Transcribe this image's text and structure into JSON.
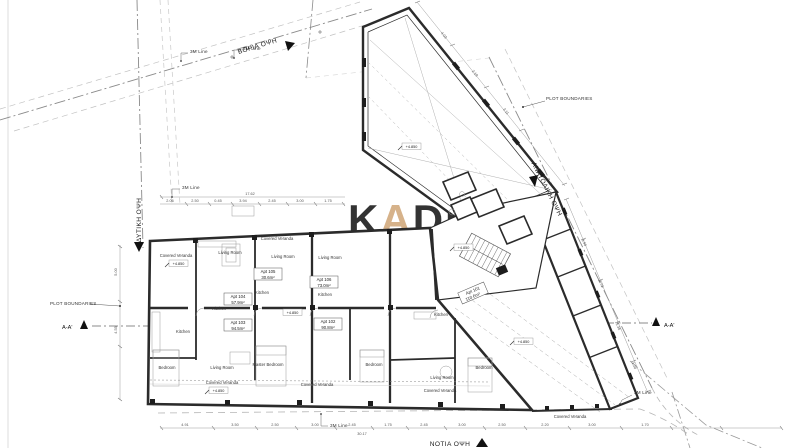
{
  "watermark": {
    "part1": "K",
    "accent": "A",
    "part2": "DIS",
    "line2": "ESTATES",
    "accent_color": "#d6b28a",
    "gray_color": "#e9e7e3"
  },
  "elevation": {
    "north": "ΒΟΡΙΑ ΟΨΗ",
    "east": "ΑΝΑΤΟΛΙΚΗ ΟΨΗ",
    "west": "ΔΥΤΙΚΗ ΟΨΗ",
    "south": "ΝΟΤΙΑ ΟΨΗ"
  },
  "misc": {
    "plot_boundaries": "PLOT BOUNDARIES",
    "section": "A-A'",
    "line_3m": "3M Line",
    "level": "+4.850"
  },
  "rooms": {
    "covered_veranda": "Covered Veranda",
    "living_room": "Living Room",
    "kitchen": "Kitchen",
    "bedroom": "Bedroom",
    "master_bedroom": "Master Bedroom"
  },
  "apartments": [
    {
      "id": "Apt 101",
      "area": "110.6m²"
    },
    {
      "id": "Apt 102",
      "area": "90.8m²"
    },
    {
      "id": "Apt 103",
      "area": "94.5m²"
    },
    {
      "id": "Apt 104",
      "area": "57.9m²"
    },
    {
      "id": "Apt 105",
      "area": "30.6m²"
    },
    {
      "id": "Apt 106",
      "area": "73.0m²"
    }
  ],
  "dims": {
    "top_total": "17.62",
    "bottom_total": "30.17",
    "top_row": [
      "2.06",
      "2.50",
      "0.45",
      "3.94",
      "2.45",
      "3.00",
      "1.75"
    ],
    "bottom_row": [
      "4.91",
      "3.50",
      "2.50",
      "3.00",
      "2.45",
      "1.75",
      "2.45",
      "3.00",
      "2.50",
      "2.20",
      "3.00",
      "1.70"
    ],
    "east_row": [
      "5.90",
      "2.72",
      "5.36",
      "1.20"
    ],
    "wing_row": [
      "4.03",
      "2.19",
      "3.11"
    ],
    "left_col": [
      "5.00",
      "4.55"
    ]
  },
  "colors": {
    "wall": "#2b2b2b",
    "boundary": "#8a8a8a",
    "faint": "#c2c2c2",
    "dimension": "#999999"
  }
}
